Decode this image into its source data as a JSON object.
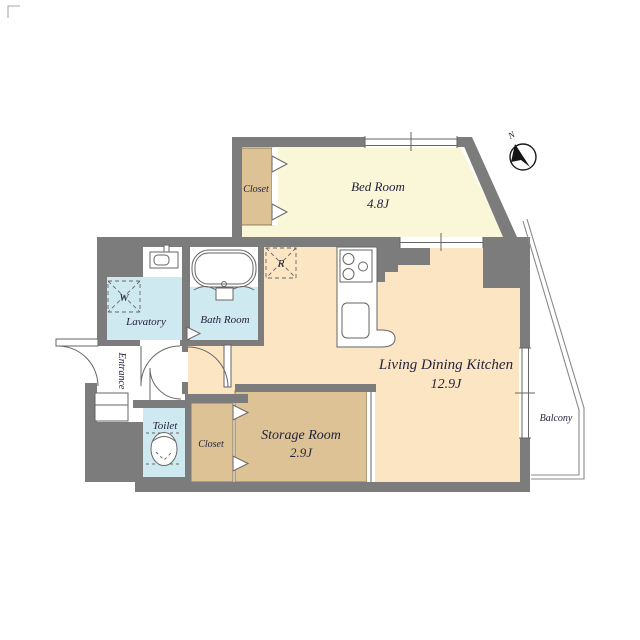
{
  "plan": {
    "rooms": {
      "bedroom": {
        "label": "Bed Room",
        "size": "4.8J"
      },
      "ldk": {
        "label": "Living Dining Kitchen",
        "size": "12.9J"
      },
      "storage": {
        "label": "Storage Room",
        "size": "2.9J"
      },
      "closet_top": {
        "label": "Closet"
      },
      "closet_bottom": {
        "label": "Closet"
      },
      "lavatory": {
        "label": "Lavatory"
      },
      "bathroom": {
        "label": "Bath Room"
      },
      "toilet": {
        "label": "Toilet"
      },
      "entrance": {
        "label": "Entrance"
      },
      "balcony": {
        "label": "Balcony"
      }
    },
    "markers": {
      "washer": "W",
      "refrigerator": "R",
      "compass_north": "N"
    },
    "colors": {
      "wall": "#7c7c7c",
      "bedroom": "#faf6d8",
      "ldk": "#fbe5c3",
      "closet": "#dcc295",
      "water": "#cfe9f1",
      "line": "#666666",
      "balcony_line": "#8a8a8a",
      "text": "#23233d"
    }
  }
}
